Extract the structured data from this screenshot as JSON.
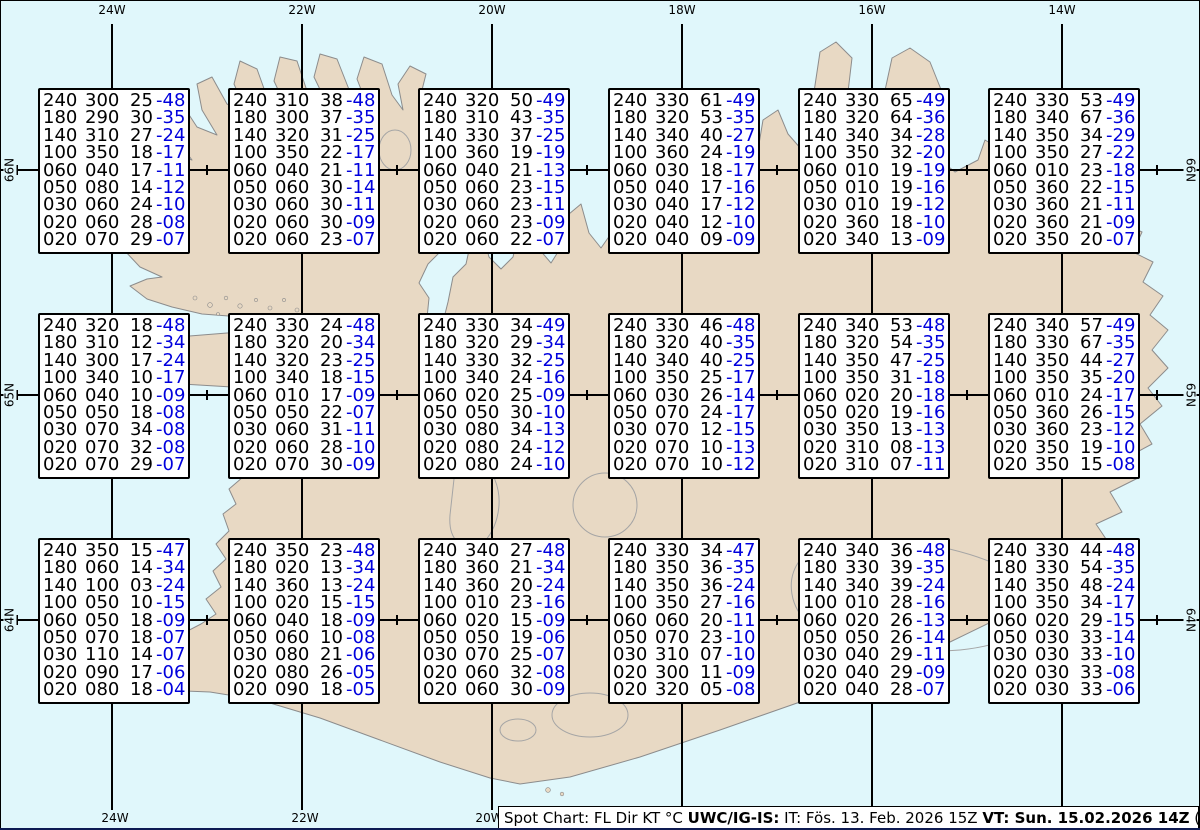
{
  "colors": {
    "sea": "#e0f7fb",
    "land": "#e8d9c4",
    "coastline": "#8c8c8c",
    "grid": "#000000",
    "box_text": "#000000",
    "temperature_text": "#0000dd"
  },
  "graticule": {
    "top_labels": [
      "24W",
      "22W",
      "20W",
      "18W",
      "16W",
      "14W"
    ],
    "bottom_labels": [
      "24W",
      "22W",
      "20W"
    ],
    "left_labels": [
      "66N",
      "65N",
      "64N"
    ],
    "right_labels": [
      "66N",
      "65N",
      "64N"
    ]
  },
  "spot_boxes": [
    {
      "rows": [
        [
          "240",
          "300",
          "25",
          "-48"
        ],
        [
          "180",
          "290",
          "30",
          "-35"
        ],
        [
          "140",
          "310",
          "27",
          "-24"
        ],
        [
          "100",
          "350",
          "18",
          "-17"
        ],
        [
          "060",
          "040",
          "17",
          "-11"
        ],
        [
          "050",
          "080",
          "14",
          "-12"
        ],
        [
          "030",
          "060",
          "24",
          "-10"
        ],
        [
          "020",
          "060",
          "28",
          "-08"
        ],
        [
          "020",
          "070",
          "29",
          "-07"
        ]
      ]
    },
    {
      "rows": [
        [
          "240",
          "310",
          "38",
          "-48"
        ],
        [
          "180",
          "300",
          "37",
          "-35"
        ],
        [
          "140",
          "320",
          "31",
          "-25"
        ],
        [
          "100",
          "350",
          "22",
          "-17"
        ],
        [
          "060",
          "040",
          "21",
          "-11"
        ],
        [
          "050",
          "060",
          "30",
          "-14"
        ],
        [
          "030",
          "060",
          "30",
          "-11"
        ],
        [
          "020",
          "060",
          "30",
          "-09"
        ],
        [
          "020",
          "060",
          "23",
          "-07"
        ]
      ]
    },
    {
      "rows": [
        [
          "240",
          "320",
          "50",
          "-49"
        ],
        [
          "180",
          "310",
          "43",
          "-35"
        ],
        [
          "140",
          "330",
          "37",
          "-25"
        ],
        [
          "100",
          "360",
          "19",
          "-19"
        ],
        [
          "060",
          "040",
          "21",
          "-13"
        ],
        [
          "050",
          "060",
          "23",
          "-15"
        ],
        [
          "030",
          "060",
          "23",
          "-11"
        ],
        [
          "020",
          "060",
          "23",
          "-09"
        ],
        [
          "020",
          "060",
          "22",
          "-07"
        ]
      ]
    },
    {
      "rows": [
        [
          "240",
          "330",
          "61",
          "-49"
        ],
        [
          "180",
          "320",
          "53",
          "-35"
        ],
        [
          "140",
          "340",
          "40",
          "-27"
        ],
        [
          "100",
          "360",
          "24",
          "-19"
        ],
        [
          "060",
          "030",
          "18",
          "-17"
        ],
        [
          "050",
          "040",
          "17",
          "-16"
        ],
        [
          "030",
          "040",
          "17",
          "-12"
        ],
        [
          "020",
          "040",
          "12",
          "-10"
        ],
        [
          "020",
          "040",
          "09",
          "-09"
        ]
      ]
    },
    {
      "rows": [
        [
          "240",
          "330",
          "65",
          "-49"
        ],
        [
          "180",
          "320",
          "64",
          "-36"
        ],
        [
          "140",
          "340",
          "34",
          "-28"
        ],
        [
          "100",
          "350",
          "32",
          "-20"
        ],
        [
          "060",
          "010",
          "19",
          "-19"
        ],
        [
          "050",
          "010",
          "19",
          "-16"
        ],
        [
          "030",
          "010",
          "19",
          "-12"
        ],
        [
          "020",
          "360",
          "18",
          "-10"
        ],
        [
          "020",
          "340",
          "13",
          "-09"
        ]
      ]
    },
    {
      "rows": [
        [
          "240",
          "330",
          "53",
          "-49"
        ],
        [
          "180",
          "340",
          "67",
          "-36"
        ],
        [
          "140",
          "350",
          "34",
          "-29"
        ],
        [
          "100",
          "350",
          "27",
          "-22"
        ],
        [
          "060",
          "010",
          "23",
          "-18"
        ],
        [
          "050",
          "360",
          "22",
          "-15"
        ],
        [
          "030",
          "360",
          "21",
          "-11"
        ],
        [
          "020",
          "360",
          "21",
          "-09"
        ],
        [
          "020",
          "350",
          "20",
          "-07"
        ]
      ]
    },
    {
      "rows": [
        [
          "240",
          "320",
          "18",
          "-48"
        ],
        [
          "180",
          "310",
          "12",
          "-34"
        ],
        [
          "140",
          "300",
          "17",
          "-24"
        ],
        [
          "100",
          "340",
          "10",
          "-17"
        ],
        [
          "060",
          "040",
          "10",
          "-09"
        ],
        [
          "050",
          "050",
          "18",
          "-08"
        ],
        [
          "030",
          "070",
          "34",
          "-08"
        ],
        [
          "020",
          "070",
          "32",
          "-08"
        ],
        [
          "020",
          "070",
          "29",
          "-07"
        ]
      ]
    },
    {
      "rows": [
        [
          "240",
          "330",
          "24",
          "-48"
        ],
        [
          "180",
          "320",
          "20",
          "-34"
        ],
        [
          "140",
          "320",
          "23",
          "-25"
        ],
        [
          "100",
          "340",
          "18",
          "-15"
        ],
        [
          "060",
          "010",
          "17",
          "-09"
        ],
        [
          "050",
          "050",
          "22",
          "-07"
        ],
        [
          "030",
          "060",
          "31",
          "-11"
        ],
        [
          "020",
          "060",
          "28",
          "-10"
        ],
        [
          "020",
          "070",
          "30",
          "-09"
        ]
      ]
    },
    {
      "rows": [
        [
          "240",
          "330",
          "34",
          "-49"
        ],
        [
          "180",
          "320",
          "29",
          "-34"
        ],
        [
          "140",
          "330",
          "32",
          "-25"
        ],
        [
          "100",
          "340",
          "24",
          "-16"
        ],
        [
          "060",
          "020",
          "25",
          "-09"
        ],
        [
          "050",
          "050",
          "30",
          "-10"
        ],
        [
          "030",
          "080",
          "34",
          "-13"
        ],
        [
          "020",
          "080",
          "24",
          "-12"
        ],
        [
          "020",
          "080",
          "24",
          "-10"
        ]
      ]
    },
    {
      "rows": [
        [
          "240",
          "330",
          "46",
          "-48"
        ],
        [
          "180",
          "320",
          "40",
          "-35"
        ],
        [
          "140",
          "340",
          "40",
          "-25"
        ],
        [
          "100",
          "350",
          "25",
          "-17"
        ],
        [
          "060",
          "030",
          "26",
          "-14"
        ],
        [
          "050",
          "070",
          "24",
          "-17"
        ],
        [
          "030",
          "070",
          "12",
          "-15"
        ],
        [
          "020",
          "070",
          "10",
          "-13"
        ],
        [
          "020",
          "070",
          "10",
          "-12"
        ]
      ]
    },
    {
      "rows": [
        [
          "240",
          "340",
          "53",
          "-48"
        ],
        [
          "180",
          "320",
          "54",
          "-35"
        ],
        [
          "140",
          "350",
          "47",
          "-25"
        ],
        [
          "100",
          "350",
          "31",
          "-18"
        ],
        [
          "060",
          "020",
          "20",
          "-18"
        ],
        [
          "050",
          "020",
          "19",
          "-16"
        ],
        [
          "030",
          "350",
          "13",
          "-13"
        ],
        [
          "020",
          "310",
          "08",
          "-13"
        ],
        [
          "020",
          "310",
          "07",
          "-11"
        ]
      ]
    },
    {
      "rows": [
        [
          "240",
          "340",
          "57",
          "-49"
        ],
        [
          "180",
          "330",
          "67",
          "-35"
        ],
        [
          "140",
          "350",
          "44",
          "-27"
        ],
        [
          "100",
          "350",
          "35",
          "-20"
        ],
        [
          "060",
          "010",
          "24",
          "-17"
        ],
        [
          "050",
          "360",
          "26",
          "-15"
        ],
        [
          "030",
          "360",
          "23",
          "-12"
        ],
        [
          "020",
          "350",
          "19",
          "-10"
        ],
        [
          "020",
          "350",
          "15",
          "-08"
        ]
      ]
    },
    {
      "rows": [
        [
          "240",
          "350",
          "15",
          "-47"
        ],
        [
          "180",
          "060",
          "14",
          "-34"
        ],
        [
          "140",
          "100",
          "03",
          "-24"
        ],
        [
          "100",
          "050",
          "10",
          "-15"
        ],
        [
          "060",
          "050",
          "18",
          "-09"
        ],
        [
          "050",
          "070",
          "18",
          "-07"
        ],
        [
          "030",
          "110",
          "14",
          "-07"
        ],
        [
          "020",
          "090",
          "17",
          "-06"
        ],
        [
          "020",
          "080",
          "18",
          "-04"
        ]
      ]
    },
    {
      "rows": [
        [
          "240",
          "350",
          "23",
          "-48"
        ],
        [
          "180",
          "020",
          "13",
          "-34"
        ],
        [
          "140",
          "360",
          "13",
          "-24"
        ],
        [
          "100",
          "020",
          "15",
          "-15"
        ],
        [
          "060",
          "040",
          "18",
          "-09"
        ],
        [
          "050",
          "060",
          "10",
          "-08"
        ],
        [
          "030",
          "080",
          "21",
          "-06"
        ],
        [
          "020",
          "080",
          "26",
          "-05"
        ],
        [
          "020",
          "090",
          "18",
          "-05"
        ]
      ]
    },
    {
      "rows": [
        [
          "240",
          "340",
          "27",
          "-48"
        ],
        [
          "180",
          "360",
          "21",
          "-34"
        ],
        [
          "140",
          "360",
          "20",
          "-24"
        ],
        [
          "100",
          "010",
          "23",
          "-16"
        ],
        [
          "060",
          "020",
          "15",
          "-09"
        ],
        [
          "050",
          "050",
          "19",
          "-06"
        ],
        [
          "030",
          "070",
          "25",
          "-07"
        ],
        [
          "020",
          "060",
          "32",
          "-08"
        ],
        [
          "020",
          "060",
          "30",
          "-09"
        ]
      ]
    },
    {
      "rows": [
        [
          "240",
          "330",
          "34",
          "-47"
        ],
        [
          "180",
          "350",
          "36",
          "-35"
        ],
        [
          "140",
          "350",
          "36",
          "-24"
        ],
        [
          "100",
          "350",
          "27",
          "-16"
        ],
        [
          "060",
          "060",
          "20",
          "-11"
        ],
        [
          "050",
          "070",
          "23",
          "-10"
        ],
        [
          "030",
          "310",
          "07",
          "-10"
        ],
        [
          "020",
          "300",
          "11",
          "-09"
        ],
        [
          "020",
          "320",
          "05",
          "-08"
        ]
      ]
    },
    {
      "rows": [
        [
          "240",
          "340",
          "36",
          "-48"
        ],
        [
          "180",
          "330",
          "39",
          "-35"
        ],
        [
          "140",
          "340",
          "39",
          "-24"
        ],
        [
          "100",
          "010",
          "28",
          "-16"
        ],
        [
          "060",
          "020",
          "26",
          "-13"
        ],
        [
          "050",
          "050",
          "26",
          "-14"
        ],
        [
          "030",
          "040",
          "29",
          "-11"
        ],
        [
          "020",
          "040",
          "29",
          "-09"
        ],
        [
          "020",
          "040",
          "28",
          "-07"
        ]
      ]
    },
    {
      "rows": [
        [
          "240",
          "330",
          "44",
          "-48"
        ],
        [
          "180",
          "330",
          "54",
          "-35"
        ],
        [
          "140",
          "350",
          "48",
          "-24"
        ],
        [
          "100",
          "350",
          "34",
          "-17"
        ],
        [
          "060",
          "020",
          "29",
          "-15"
        ],
        [
          "050",
          "030",
          "33",
          "-14"
        ],
        [
          "030",
          "030",
          "33",
          "-10"
        ],
        [
          "020",
          "030",
          "33",
          "-08"
        ],
        [
          "020",
          "030",
          "33",
          "-06"
        ]
      ]
    }
  ],
  "footer": {
    "segments": [
      {
        "text": "Spot Chart: FL Dir KT °C ",
        "bold": false
      },
      {
        "text": "UWC/IG-IS:",
        "bold": true
      },
      {
        "text": " IT: Fös. 13. Feb. 2026 15Z ",
        "bold": false
      },
      {
        "text": "VT: Sun. 15.02.2026 14Z",
        "bold": true
      },
      {
        "text": " (+47 h)",
        "bold": false
      }
    ]
  }
}
